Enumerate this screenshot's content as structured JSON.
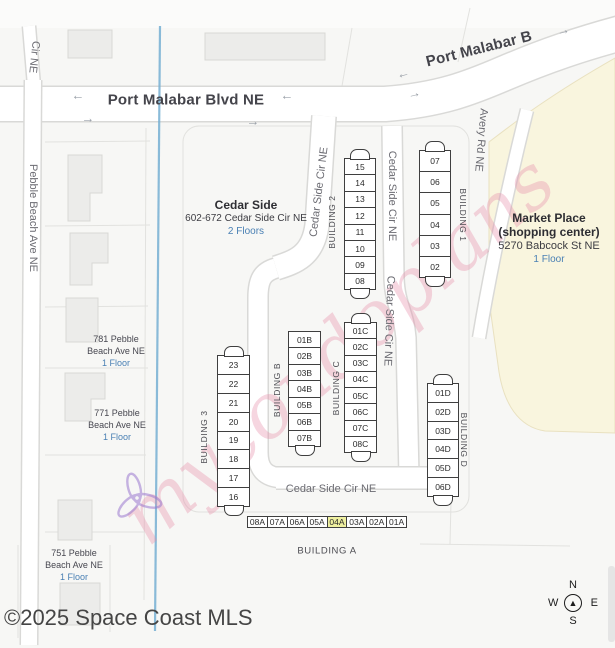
{
  "map": {
    "streets": {
      "port_malabar": "Port Malabar Blvd NE",
      "port_malabar_diag": "Port Malabar B",
      "cir_ne": "Cir NE",
      "pebble_beach": "Pebble Beach Ave NE",
      "avery": "Avery Rd NE",
      "cedar_side_cir": "Cedar Side Cir NE"
    },
    "complex": {
      "name": "Cedar Side",
      "address": "602-672 Cedar Side Cir NE",
      "floors": "2 Floors"
    },
    "market": {
      "name": "Market Place",
      "subtitle": "(shopping center)",
      "address": "5270 Babcock St NE",
      "floors": "1 Floor"
    },
    "houses": [
      {
        "line1": "781 Pebble",
        "line2": "Beach Ave NE",
        "floors": "1 Floor"
      },
      {
        "line1": "771 Pebble",
        "line2": "Beach Ave NE",
        "floors": "1 Floor"
      },
      {
        "line1": "751 Pebble",
        "line2": "Beach Ave NE",
        "floors": "1 Floor"
      }
    ],
    "buildings": {
      "b1": {
        "label": "BUILDING 1",
        "units": [
          "07",
          "06",
          "05",
          "04",
          "03",
          "02"
        ]
      },
      "b2": {
        "label": "BUILDING 2",
        "units": [
          "15",
          "14",
          "13",
          "12",
          "11",
          "10",
          "09",
          "08"
        ]
      },
      "b3": {
        "label": "BUILDING 3",
        "units": [
          "23",
          "22",
          "21",
          "20",
          "19",
          "18",
          "17",
          "16"
        ]
      },
      "bA": {
        "label": "BUILDING A",
        "units": [
          "08A",
          "07A",
          "06A",
          "05A",
          "04A",
          "03A",
          "02A",
          "01A"
        ],
        "highlight": "04A"
      },
      "bB": {
        "label": "BUILDING B",
        "units": [
          "01B",
          "02B",
          "03B",
          "04B",
          "05B",
          "06B",
          "07B"
        ]
      },
      "bC": {
        "label": "BUILDING C",
        "units": [
          "01C",
          "02C",
          "03C",
          "04C",
          "05C",
          "06C",
          "07C",
          "08C"
        ]
      },
      "bD": {
        "label": "BUILDING D",
        "units": [
          "01D",
          "02D",
          "03D",
          "04D",
          "05D",
          "06D"
        ]
      }
    },
    "arrows": {
      "left": "←",
      "right": "→"
    },
    "compass": {
      "n": "N",
      "s": "S",
      "e": "E",
      "w": "W",
      "needle": "▲"
    },
    "watermark": "mycondoplans",
    "copyright": "©2025 Space Coast MLS",
    "colors": {
      "highlight": "#eff0a0",
      "floors_blue": "#4a80b4",
      "canal": "#76afd2",
      "market_fill": "#f9f5de",
      "watermark_pink": "#e78ba8"
    }
  }
}
